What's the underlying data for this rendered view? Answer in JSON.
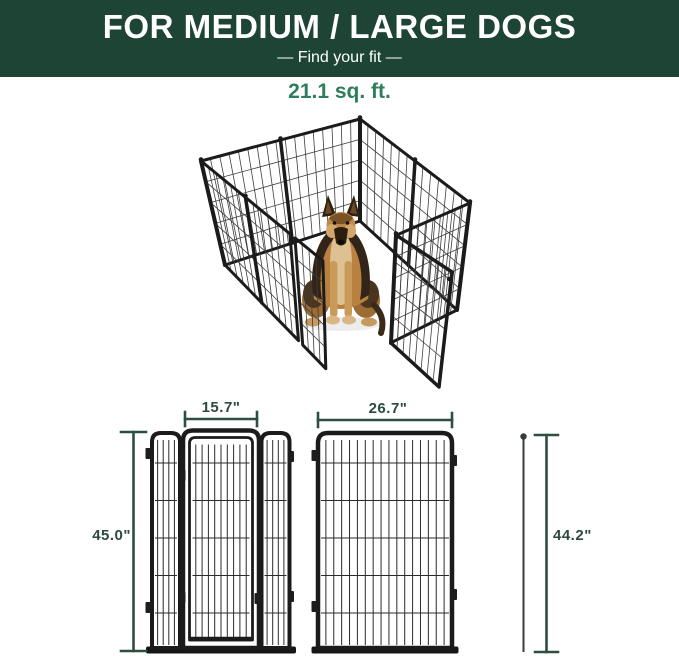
{
  "banner": {
    "title": "FOR MEDIUM / LARGE DOGS",
    "subtitle": "—  Find your fit  —",
    "bg_color": "#1d4434",
    "text_color": "#ffffff"
  },
  "area": {
    "label": "21.1 sq. ft.",
    "color": "#2e7d5b"
  },
  "figures": {
    "door_panel": {
      "width_label": "15.7\"",
      "height_label": "45.0\""
    },
    "regular_panel": {
      "width_label": "26.7\"",
      "height_label": "44.2\""
    }
  },
  "colors": {
    "dimension_line": "#2d4f40",
    "dimension_text": "#2c4a3d",
    "pen_frame": "#1b1b1b",
    "pen_wire": "#3d3d3d",
    "base_bar": "#161616",
    "dog_tan": "#c08a4e",
    "dog_dark": "#33241a"
  }
}
